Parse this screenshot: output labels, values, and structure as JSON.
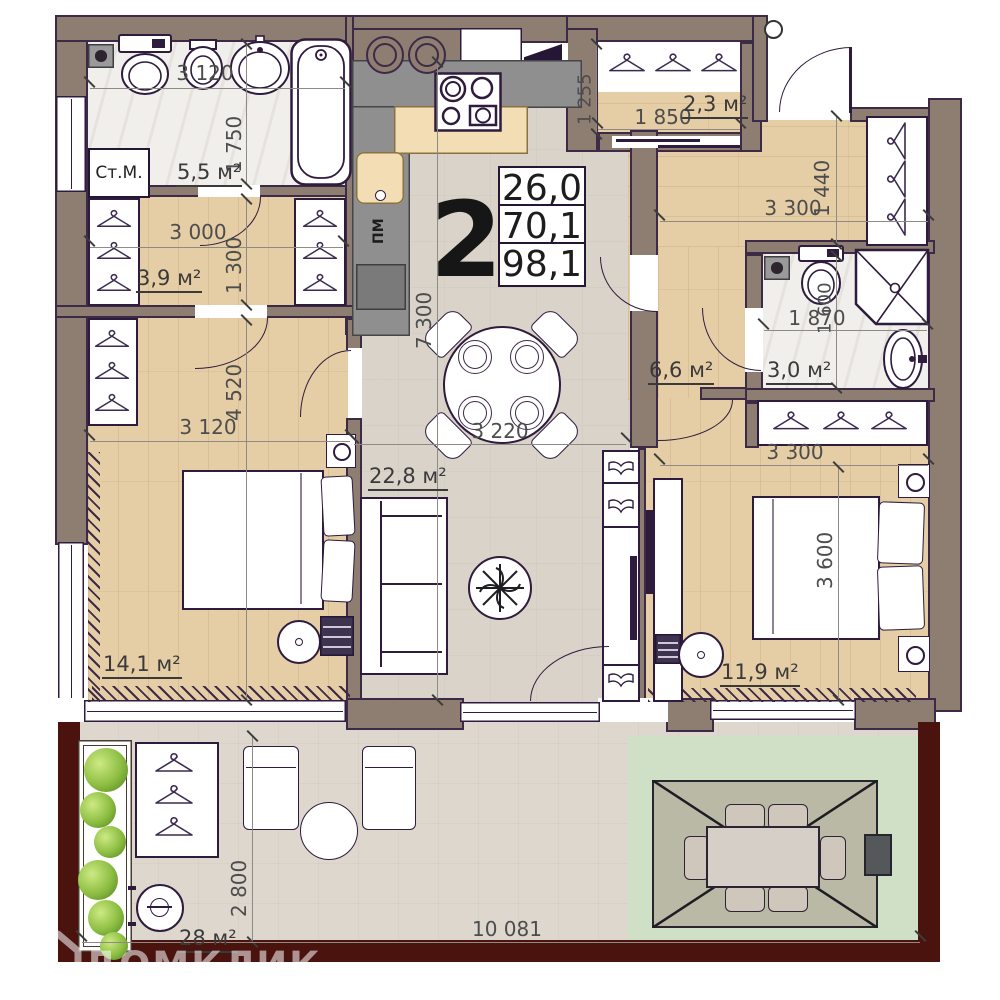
{
  "meta": {
    "watermark": "ДОМКЛИК"
  },
  "info_box": {
    "rooms_count": "2",
    "areas": [
      "26,0",
      "70,1",
      "98,1"
    ]
  },
  "rooms": {
    "bathroom1": {
      "area": "5,5 м²"
    },
    "hallway1": {
      "area": "3,9 м²"
    },
    "bedroom1": {
      "area": "14,1 м²"
    },
    "kitchen_living": {
      "area": "22,8 м²"
    },
    "closet": {
      "area": "2,3 м²"
    },
    "hallway2": {
      "area": "6,6 м²"
    },
    "bathroom2": {
      "area": "3,0 м²"
    },
    "bedroom2": {
      "area": "11,9 м²"
    },
    "terrace": {
      "area": "28 м²"
    }
  },
  "appliances": {
    "washing_machine": "Ст.М.",
    "dishwasher": "ПМ"
  },
  "dimensions": {
    "bathroom1_width": "3 120",
    "bathroom1_depth": "1 750",
    "hallway1_width": "3 000",
    "hallway1_depth": "1 300",
    "bedroom1_width": "3 120",
    "bedroom1_depth": "4 520",
    "living_depth": "7 300",
    "living_width": "3 220",
    "closet_depth": "1 255",
    "closet_width": "1 850",
    "corridor_width": "3 300",
    "corridor_depth": "1 440",
    "bathroom2_width": "1 870",
    "bathroom2_depth": "1 600",
    "bedroom2_width": "3 300",
    "bedroom2_depth": "3 600",
    "terrace_depth": "2 800",
    "terrace_width": "10 081"
  },
  "colors": {
    "wall": "#8e7d71",
    "wall_outline": "#3d2a46",
    "wood": "#e5cda5",
    "tile": "#d9d3ca",
    "marble": "#f1efec",
    "terrace": "#ded7cd",
    "green_zone": "#cfe0c6",
    "terrace_wall": "#4a130e",
    "accent_dark": "#2e1b3d"
  }
}
